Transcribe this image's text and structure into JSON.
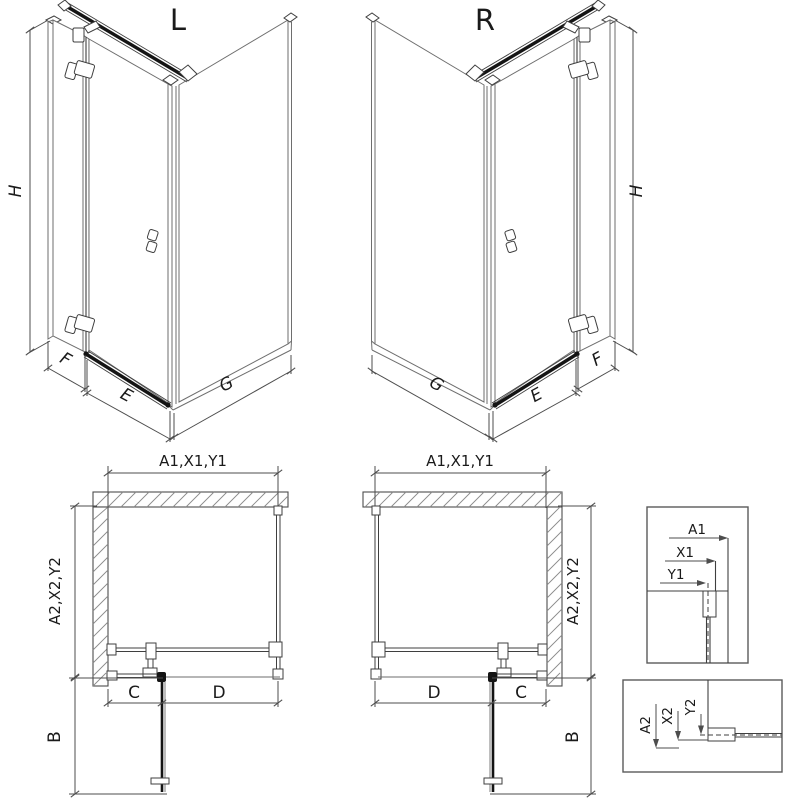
{
  "colors": {
    "line": "#6e6e6e",
    "profile": "#3f3f3f",
    "bar": "#141414",
    "dim": "#4d4d4d",
    "hatch": "#8a8a8a",
    "box": "#5a5a5a",
    "text": "#1a1a1a",
    "bg": "#ffffff"
  },
  "views": {
    "iso_left": {
      "title": "L",
      "dim_height": "H",
      "dim_side": "F",
      "dim_door": "E",
      "dim_return": "G"
    },
    "iso_right": {
      "title": "R",
      "dim_height": "H",
      "dim_side": "F",
      "dim_door": "E",
      "dim_return": "G"
    },
    "plan_left": {
      "dim_top": "A1,X1,Y1",
      "dim_side": "A2,X2,Y2",
      "dim_fixed": "C",
      "dim_door": "D",
      "dim_depth": "B"
    },
    "plan_right": {
      "dim_top": "A1,X1,Y1",
      "dim_side": "A2,X2,Y2",
      "dim_fixed": "C",
      "dim_door": "D",
      "dim_depth": "B"
    },
    "detail_top": {
      "dim_a": "A1",
      "dim_x": "X1",
      "dim_y": "Y1"
    },
    "detail_bottom": {
      "dim_a": "A2",
      "dim_x": "X2",
      "dim_y": "Y2"
    }
  }
}
